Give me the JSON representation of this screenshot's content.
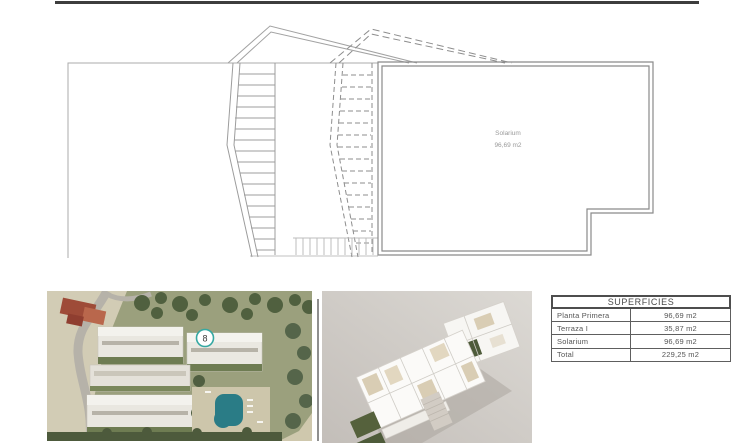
{
  "plan": {
    "room_label": "Solarium",
    "room_area": "96,69 m2"
  },
  "aerial_photo": {
    "unit_badge": "8"
  },
  "areas_table": {
    "title": "SUPERFICIES",
    "rows": [
      {
        "label": "Planta Primera",
        "value": "96,69 m2"
      },
      {
        "label": "Terraza I",
        "value": "35,87 m2"
      },
      {
        "label": "Solarium",
        "value": "96,69 m2"
      },
      {
        "label": "Total",
        "value": "229,25 m2"
      }
    ]
  },
  "colors": {
    "accent_teal": "#35a8a2",
    "plan_line_gray": "#9a9a9a",
    "top_bar_black": "#3d3d3d",
    "pool_teal": "#2a7c86"
  }
}
